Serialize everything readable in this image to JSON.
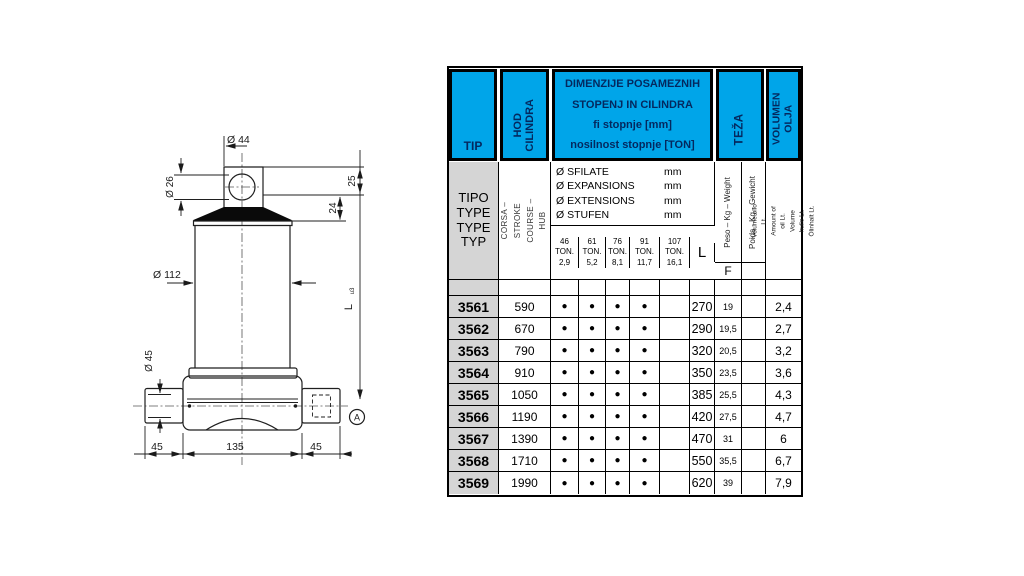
{
  "colors": {
    "header_blue": "#00A5E9",
    "header_text_navy": "#04285e",
    "tip_gray": "#d5d5d5",
    "grid_black": "#000000"
  },
  "diagram": {
    "dia_top": "Ø 44",
    "dia_hole": "Ø 26",
    "h_upper": "25",
    "h_lower": "24",
    "dia_body": "Ø 112",
    "dia_pin": "Ø 45",
    "length_label": "L",
    "length_mark": "u3",
    "base_left": "45",
    "base_mid": "135",
    "base_right": "45",
    "detail_label": "A"
  },
  "table": {
    "header": {
      "tip": "TIP",
      "hod": "HOD\nCILINDRA",
      "dimenzije": "DIMENZIJE POSAMEZNIH\nSTOPENJ IN CILINDRA\nfi stopnje [mm]\nnosilnost stopnje [TON]",
      "teza": "TEŽA",
      "volumen": "VOLUMEN\nOLJA"
    },
    "subheader": {
      "tipo": "TIPO\nTYPE\nTYPE\nTYP",
      "corsa": "CORSA – STROKE\nCOURSE – HUB",
      "phi_rows": [
        {
          "name": "Ø SFILATE",
          "unit": "mm"
        },
        {
          "name": "Ø EXPANSIONS",
          "unit": "mm"
        },
        {
          "name": "Ø EXTENSIONS",
          "unit": "mm"
        },
        {
          "name": "Ø STUFEN",
          "unit": "mm"
        }
      ],
      "ton_cols": [
        "46\nTON.\n2,9",
        "61\nTON.\n5,2",
        "76\nTON.\n8,1",
        "91\nTON.\n11,7",
        "107\nTON.\n16,1"
      ],
      "l_label": "L",
      "peso": "Peso – Kg – Weight",
      "poids": "Poids - Kg - Gewicht",
      "f_label": "F",
      "volume_lines": "Volume olio Lt.\nAmount of oil Lt.\nVolume huile Lt.\nÖlinhalt Lt."
    },
    "rows": [
      {
        "tip": "3561",
        "stroke": "590",
        "dots": [
          "●",
          "●",
          "●",
          "●",
          ""
        ],
        "L": "270",
        "weight": "19",
        "weight2": "",
        "volume": "2,4"
      },
      {
        "tip": "3562",
        "stroke": "670",
        "dots": [
          "●",
          "●",
          "●",
          "●",
          ""
        ],
        "L": "290",
        "weight": "19,5",
        "weight2": "",
        "volume": "2,7"
      },
      {
        "tip": "3563",
        "stroke": "790",
        "dots": [
          "●",
          "●",
          "●",
          "●",
          ""
        ],
        "L": "320",
        "weight": "20,5",
        "weight2": "",
        "volume": "3,2"
      },
      {
        "tip": "3564",
        "stroke": "910",
        "dots": [
          "●",
          "●",
          "●",
          "●",
          ""
        ],
        "L": "350",
        "weight": "23,5",
        "weight2": "",
        "volume": "3,6"
      },
      {
        "tip": "3565",
        "stroke": "1050",
        "dots": [
          "●",
          "●",
          "●",
          "●",
          ""
        ],
        "L": "385",
        "weight": "25,5",
        "weight2": "",
        "volume": "4,3"
      },
      {
        "tip": "3566",
        "stroke": "1190",
        "dots": [
          "●",
          "●",
          "●",
          "●",
          ""
        ],
        "L": "420",
        "weight": "27,5",
        "weight2": "",
        "volume": "4,7"
      },
      {
        "tip": "3567",
        "stroke": "1390",
        "dots": [
          "●",
          "●",
          "●",
          "●",
          ""
        ],
        "L": "470",
        "weight": "31",
        "weight2": "",
        "volume": "6"
      },
      {
        "tip": "3568",
        "stroke": "1710",
        "dots": [
          "●",
          "●",
          "●",
          "●",
          ""
        ],
        "L": "550",
        "weight": "35,5",
        "weight2": "",
        "volume": "6,7"
      },
      {
        "tip": "3569",
        "stroke": "1990",
        "dots": [
          "●",
          "●",
          "●",
          "●",
          ""
        ],
        "L": "620",
        "weight": "39",
        "weight2": "",
        "volume": "7,9"
      }
    ]
  }
}
